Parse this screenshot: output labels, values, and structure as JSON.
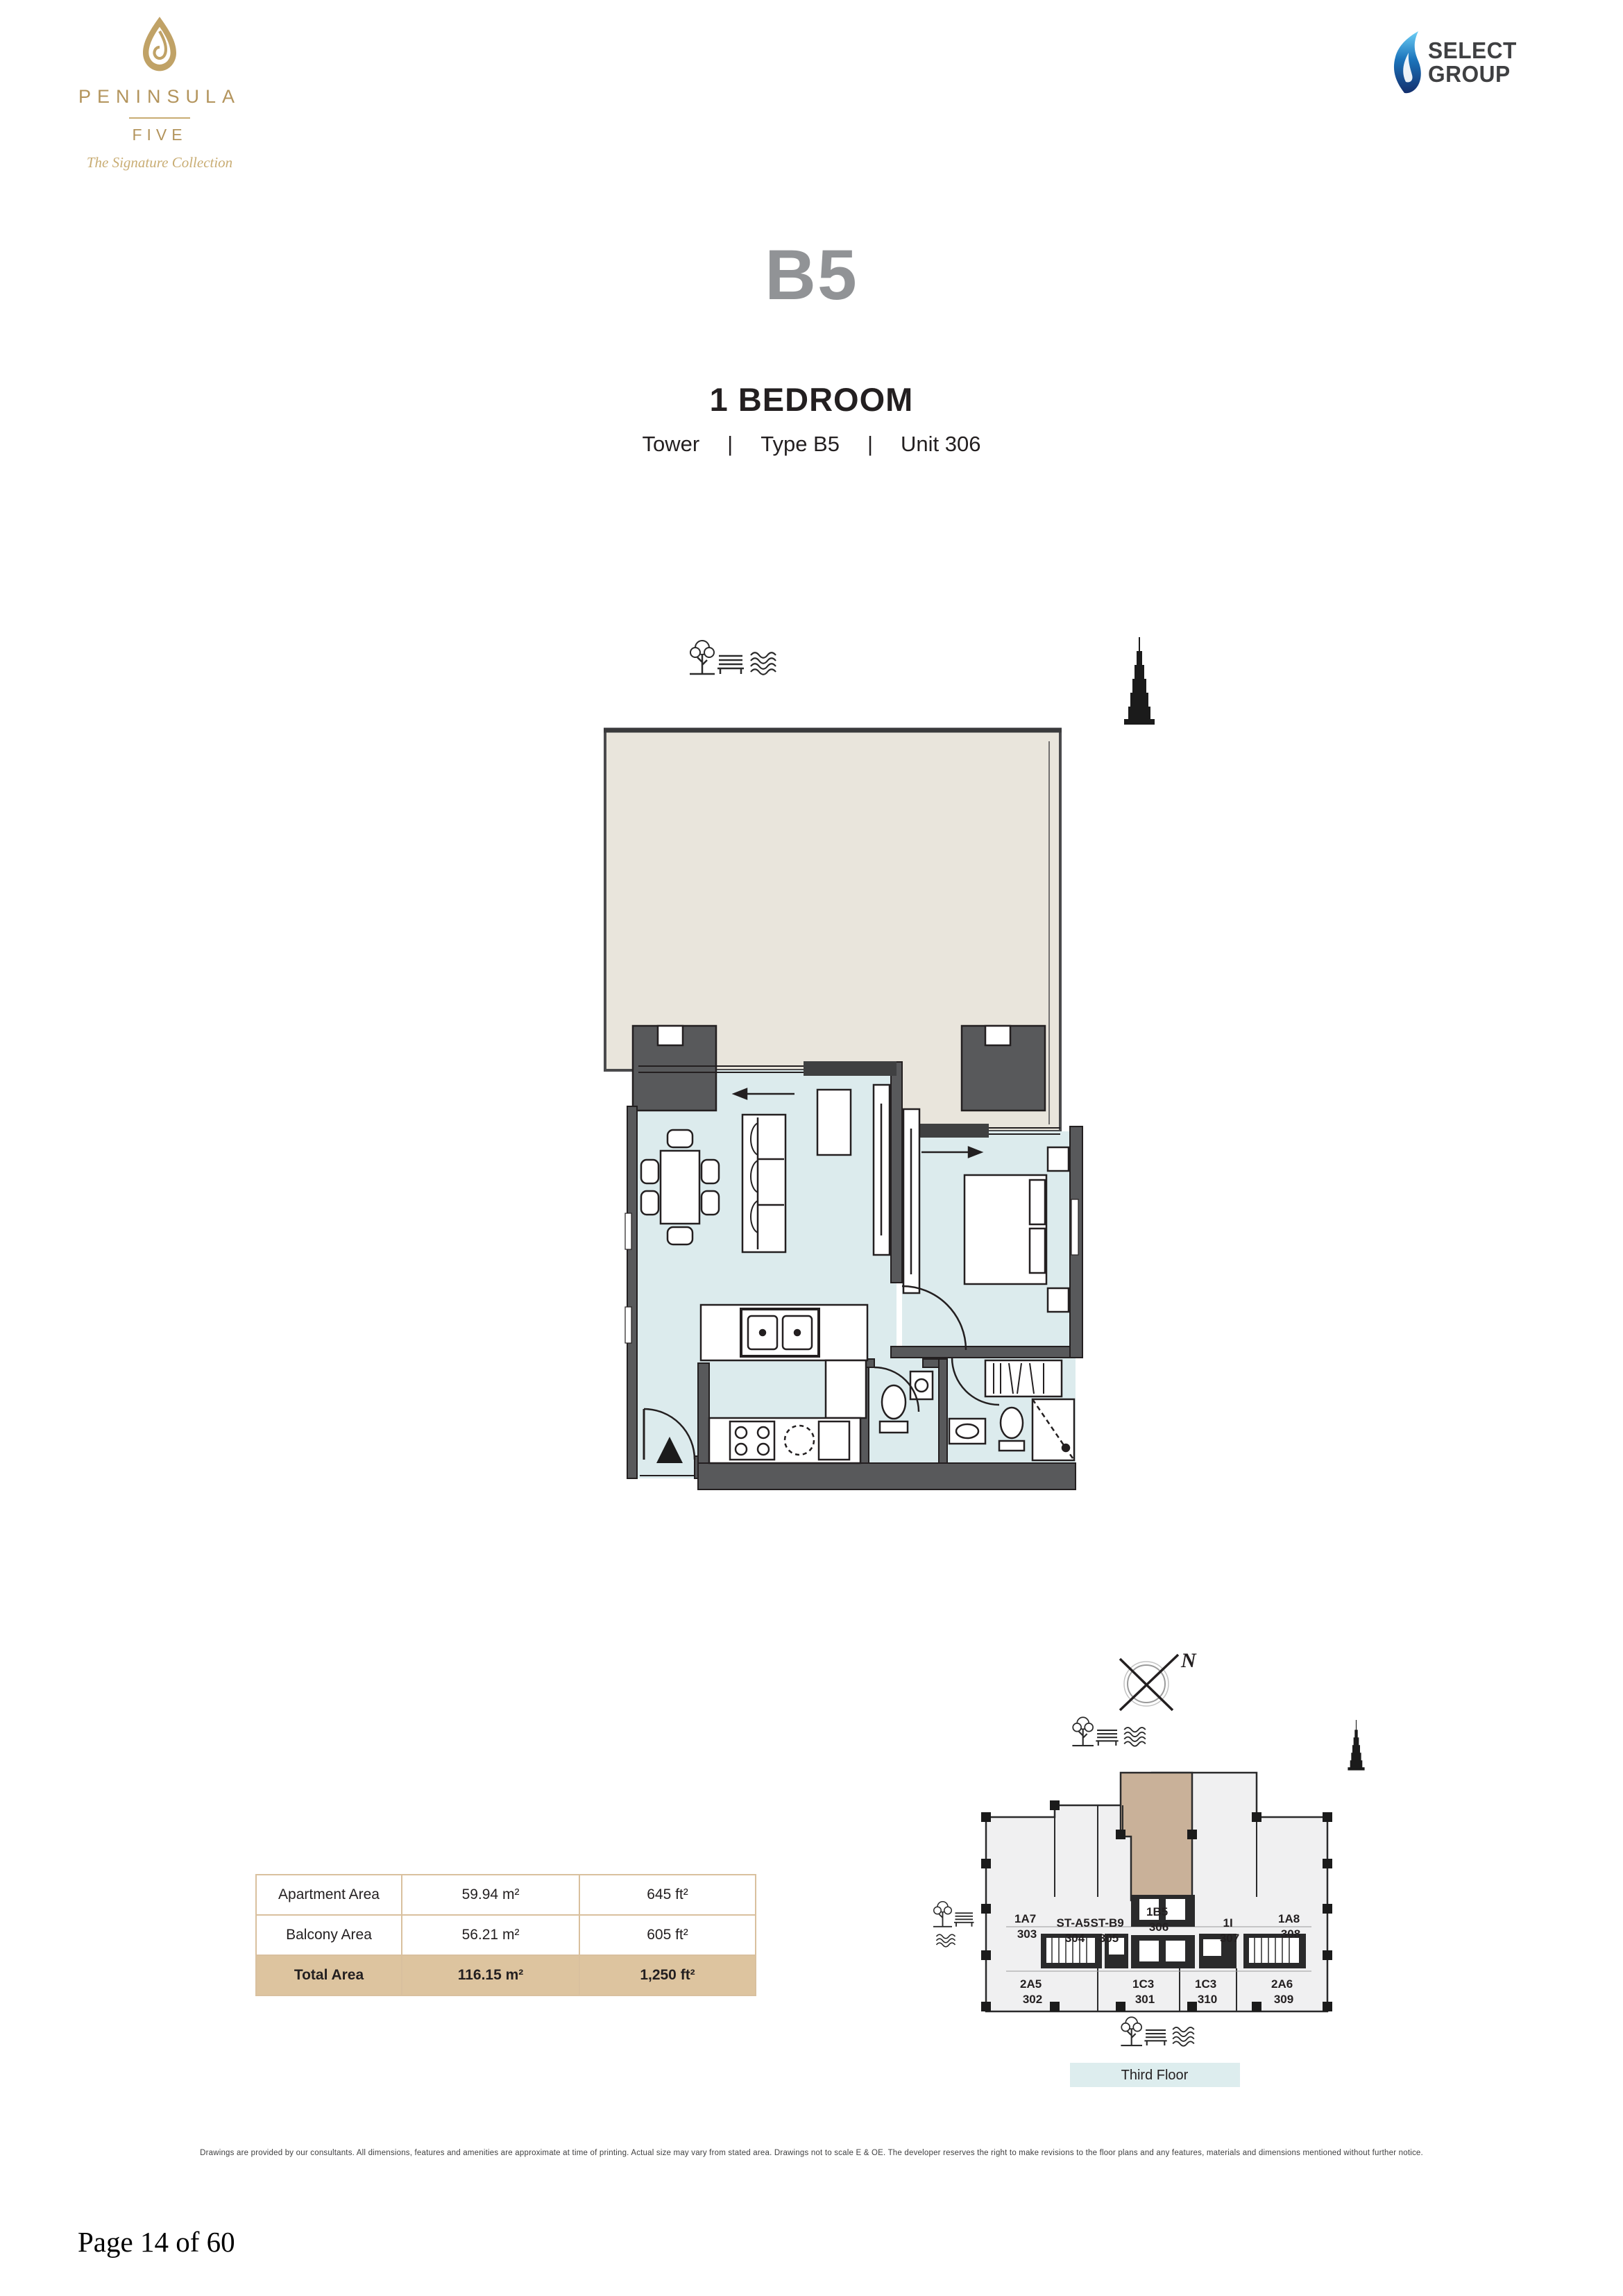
{
  "branding": {
    "peninsula": {
      "name": "PENINSULA",
      "sub": "FIVE",
      "tagline": "The Signature Collection"
    },
    "select_group": {
      "line1": "SELECT",
      "line2": "GROUP"
    }
  },
  "header": {
    "plan_code": "B5",
    "bedroom_title": "1 BEDROOM",
    "tower_label": "Tower",
    "type_label": "Type B5",
    "unit_label": "Unit 306",
    "separator": "|"
  },
  "areas_table": {
    "rows": [
      {
        "label": "Apartment Area",
        "metric": "59.94 m²",
        "imperial": "645 ft²"
      },
      {
        "label": "Balcony Area",
        "metric": "56.21 m²",
        "imperial": "605 ft²"
      },
      {
        "label": "Total Area",
        "metric": "116.15 m²",
        "imperial": "1,250 ft²"
      }
    ]
  },
  "key_plan": {
    "floor_label": "Third Floor",
    "north_label": "N",
    "units_top": [
      {
        "type": "1A7",
        "no": "303"
      },
      {
        "type": "ST-A5",
        "no": "304"
      },
      {
        "type": "ST-B9",
        "no": "305"
      },
      {
        "type": "1B5",
        "no": "306"
      },
      {
        "type": "1I",
        "no": "307"
      },
      {
        "type": "1A8",
        "no": "308"
      }
    ],
    "units_bottom": [
      {
        "type": "2A5",
        "no": "302"
      },
      {
        "type": "1C3",
        "no": "301"
      },
      {
        "type": "1C3",
        "no": "310"
      },
      {
        "type": "2A6",
        "no": "309"
      }
    ]
  },
  "footer": {
    "disclaimer": "Drawings are provided by our consultants. All dimensions, features and amenities are approximate at time of printing.  Actual size may vary from stated area. Drawings not to scale E & OE. The developer reserves the right to make revisions to the floor plans and any features, materials and dimensions mentioned without further notice.",
    "page_label": "Page 14 of 60"
  },
  "icons": {
    "tree_bench": "park-and-bench outline glyph",
    "waves": "water wave lines glyph",
    "burj": "Burj Khalifa silhouette",
    "compass": "crossed-circle north compass"
  },
  "colors": {
    "gold": "#b3945c",
    "select_blue": "#1c75bc",
    "wall_gray": "#58595b",
    "interior_blue": "#dcebed",
    "balcony_beige": "#e9e5dc",
    "highlight_tan": "#c9b199",
    "total_row_bg": "#ddc49f",
    "floor_label_bg": "#ddedee"
  }
}
